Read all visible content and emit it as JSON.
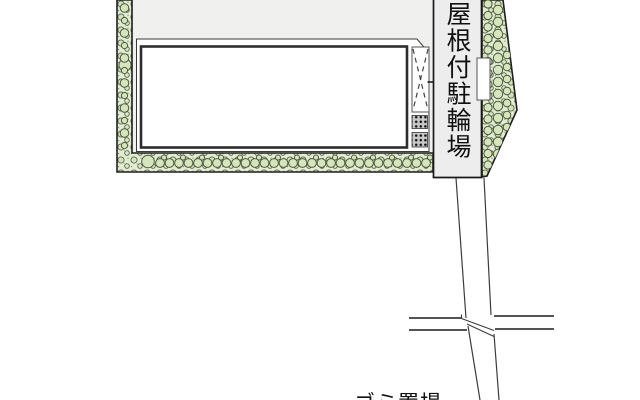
{
  "labels": {
    "covered_bicycle_parking": "屋根付駐輪場",
    "trash_area_partial": "ゴミ置場"
  },
  "legend": {
    "drawing_type": "site-plan",
    "features": [
      "building-footprint",
      "planting-border-left",
      "planting-border-bottom",
      "planting-border-right",
      "covered-bicycle-parking-strip",
      "gravel-pads",
      "gate-opening",
      "road",
      "crosswalk-lines"
    ]
  },
  "colors": {
    "site_fill": "#f0f1ee",
    "planting_fill": "#e2ecd2",
    "shrub_outline": "#4c5840",
    "outline_dark": "#1f1f1f",
    "building_wall": "#2d2d2d",
    "road_line": "#3c3c3c"
  }
}
